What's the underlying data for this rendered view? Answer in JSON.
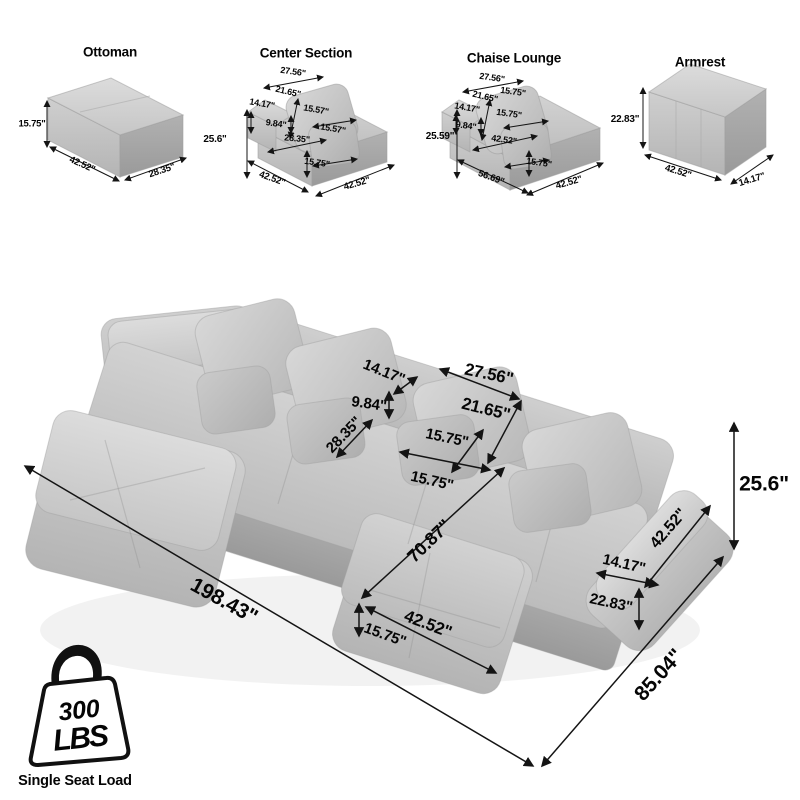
{
  "components": {
    "ottoman": {
      "title": "Ottoman",
      "height": "15.75\"",
      "width": "42.52\"",
      "depth": "28.35\""
    },
    "center_section": {
      "title": "Center Section",
      "pillow_width": "27.56\"",
      "pillow_height": "21.65\"",
      "small_pillow_width": "15.57\"",
      "small_pillow_height": "15.57\"",
      "back_height": "14.17\"",
      "back_depth": "9.84\"",
      "overall_height": "25.6\"",
      "seat_depth": "28.35\"",
      "seat_height": "15.75\"",
      "width": "42.52\"",
      "depth": "42.52\""
    },
    "chaise_lounge": {
      "title": "Chaise Lounge",
      "pillow_width": "27.56\"",
      "pillow_height": "21.65\"",
      "small_pillow_width": "15.75\"",
      "small_pillow_height": "15.75\"",
      "back_height": "14.17\"",
      "back_depth": "9.84\"",
      "overall_height": "25.59\"",
      "seat_width": "42.52\"",
      "seat_height": "15.75\"",
      "length": "56.69\"",
      "depth": "42.52\""
    },
    "armrest": {
      "title": "Armrest",
      "height": "22.83\"",
      "length": "42.52\"",
      "depth": "14.17\""
    }
  },
  "assembled": {
    "back_height": "14.17\"",
    "pillow_width": "27.56\"",
    "back_depth": "9.84\"",
    "pillow_height": "21.65\"",
    "seat_depth": "28.35\"",
    "small_pillow_height": "15.75\"",
    "small_pillow_width": "15.75\"",
    "chaise_length": "70.87\"",
    "chaise_width": "42.52\"",
    "seat_height": "15.75\"",
    "overall_length": "198.43\"",
    "overall_depth": "85.04\"",
    "overall_height": "25.6\"",
    "armrest_length": "42.52\"",
    "armrest_depth": "14.17\"",
    "armrest_height": "22.83\""
  },
  "weight_badge": {
    "value": "300",
    "unit": "LBS",
    "caption": "Single Seat Load"
  },
  "colors": {
    "line": "#141414",
    "sofa_light": "#d6d6d6",
    "sofa_mid": "#c0c0c0",
    "sofa_dark": "#a2a2a2"
  }
}
